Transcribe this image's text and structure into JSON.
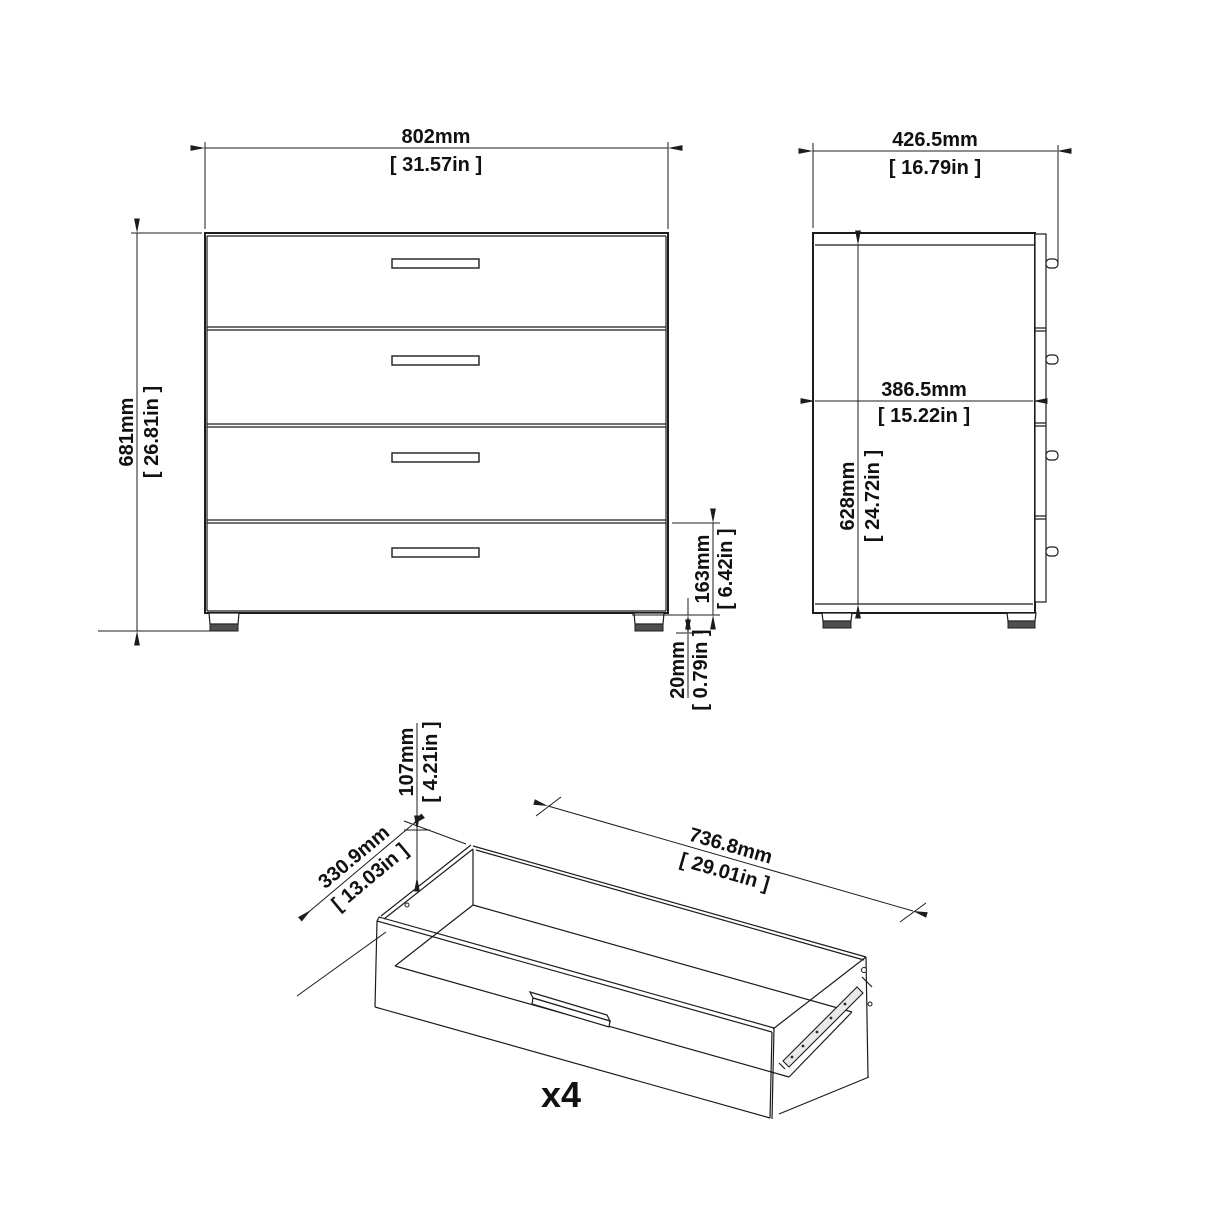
{
  "diagram_title": "4-drawer chest dimension drawing",
  "dimensions": {
    "front_width": {
      "mm": "802mm",
      "inches": "[ 31.57in ]"
    },
    "front_height": {
      "mm": "681mm",
      "inches": "[ 26.81in ]"
    },
    "drawer_front_height": {
      "mm": "163mm",
      "inches": "[ 6.42in ]"
    },
    "foot_height": {
      "mm": "20mm",
      "inches": "[ 0.79in ]"
    },
    "side_depth": {
      "mm": "426.5mm",
      "inches": "[ 16.79in ]"
    },
    "side_inner_depth": {
      "mm": "386.5mm",
      "inches": "[ 15.22in ]"
    },
    "side_inner_height": {
      "mm": "628mm",
      "inches": "[ 24.72in ]"
    },
    "drawer_height": {
      "mm": "107mm",
      "inches": "[ 4.21in ]"
    },
    "drawer_depth": {
      "mm": "330.9mm",
      "inches": "[ 13.03in ]"
    },
    "drawer_length": {
      "mm": "736.8mm",
      "inches": "[ 29.01in ]"
    },
    "drawer_quantity": "x4"
  },
  "colors": {
    "line": "#1c1c1c",
    "foot_pad": "#4f4f4f",
    "rail_fill": "#e9e9e9",
    "background": "#ffffff"
  }
}
